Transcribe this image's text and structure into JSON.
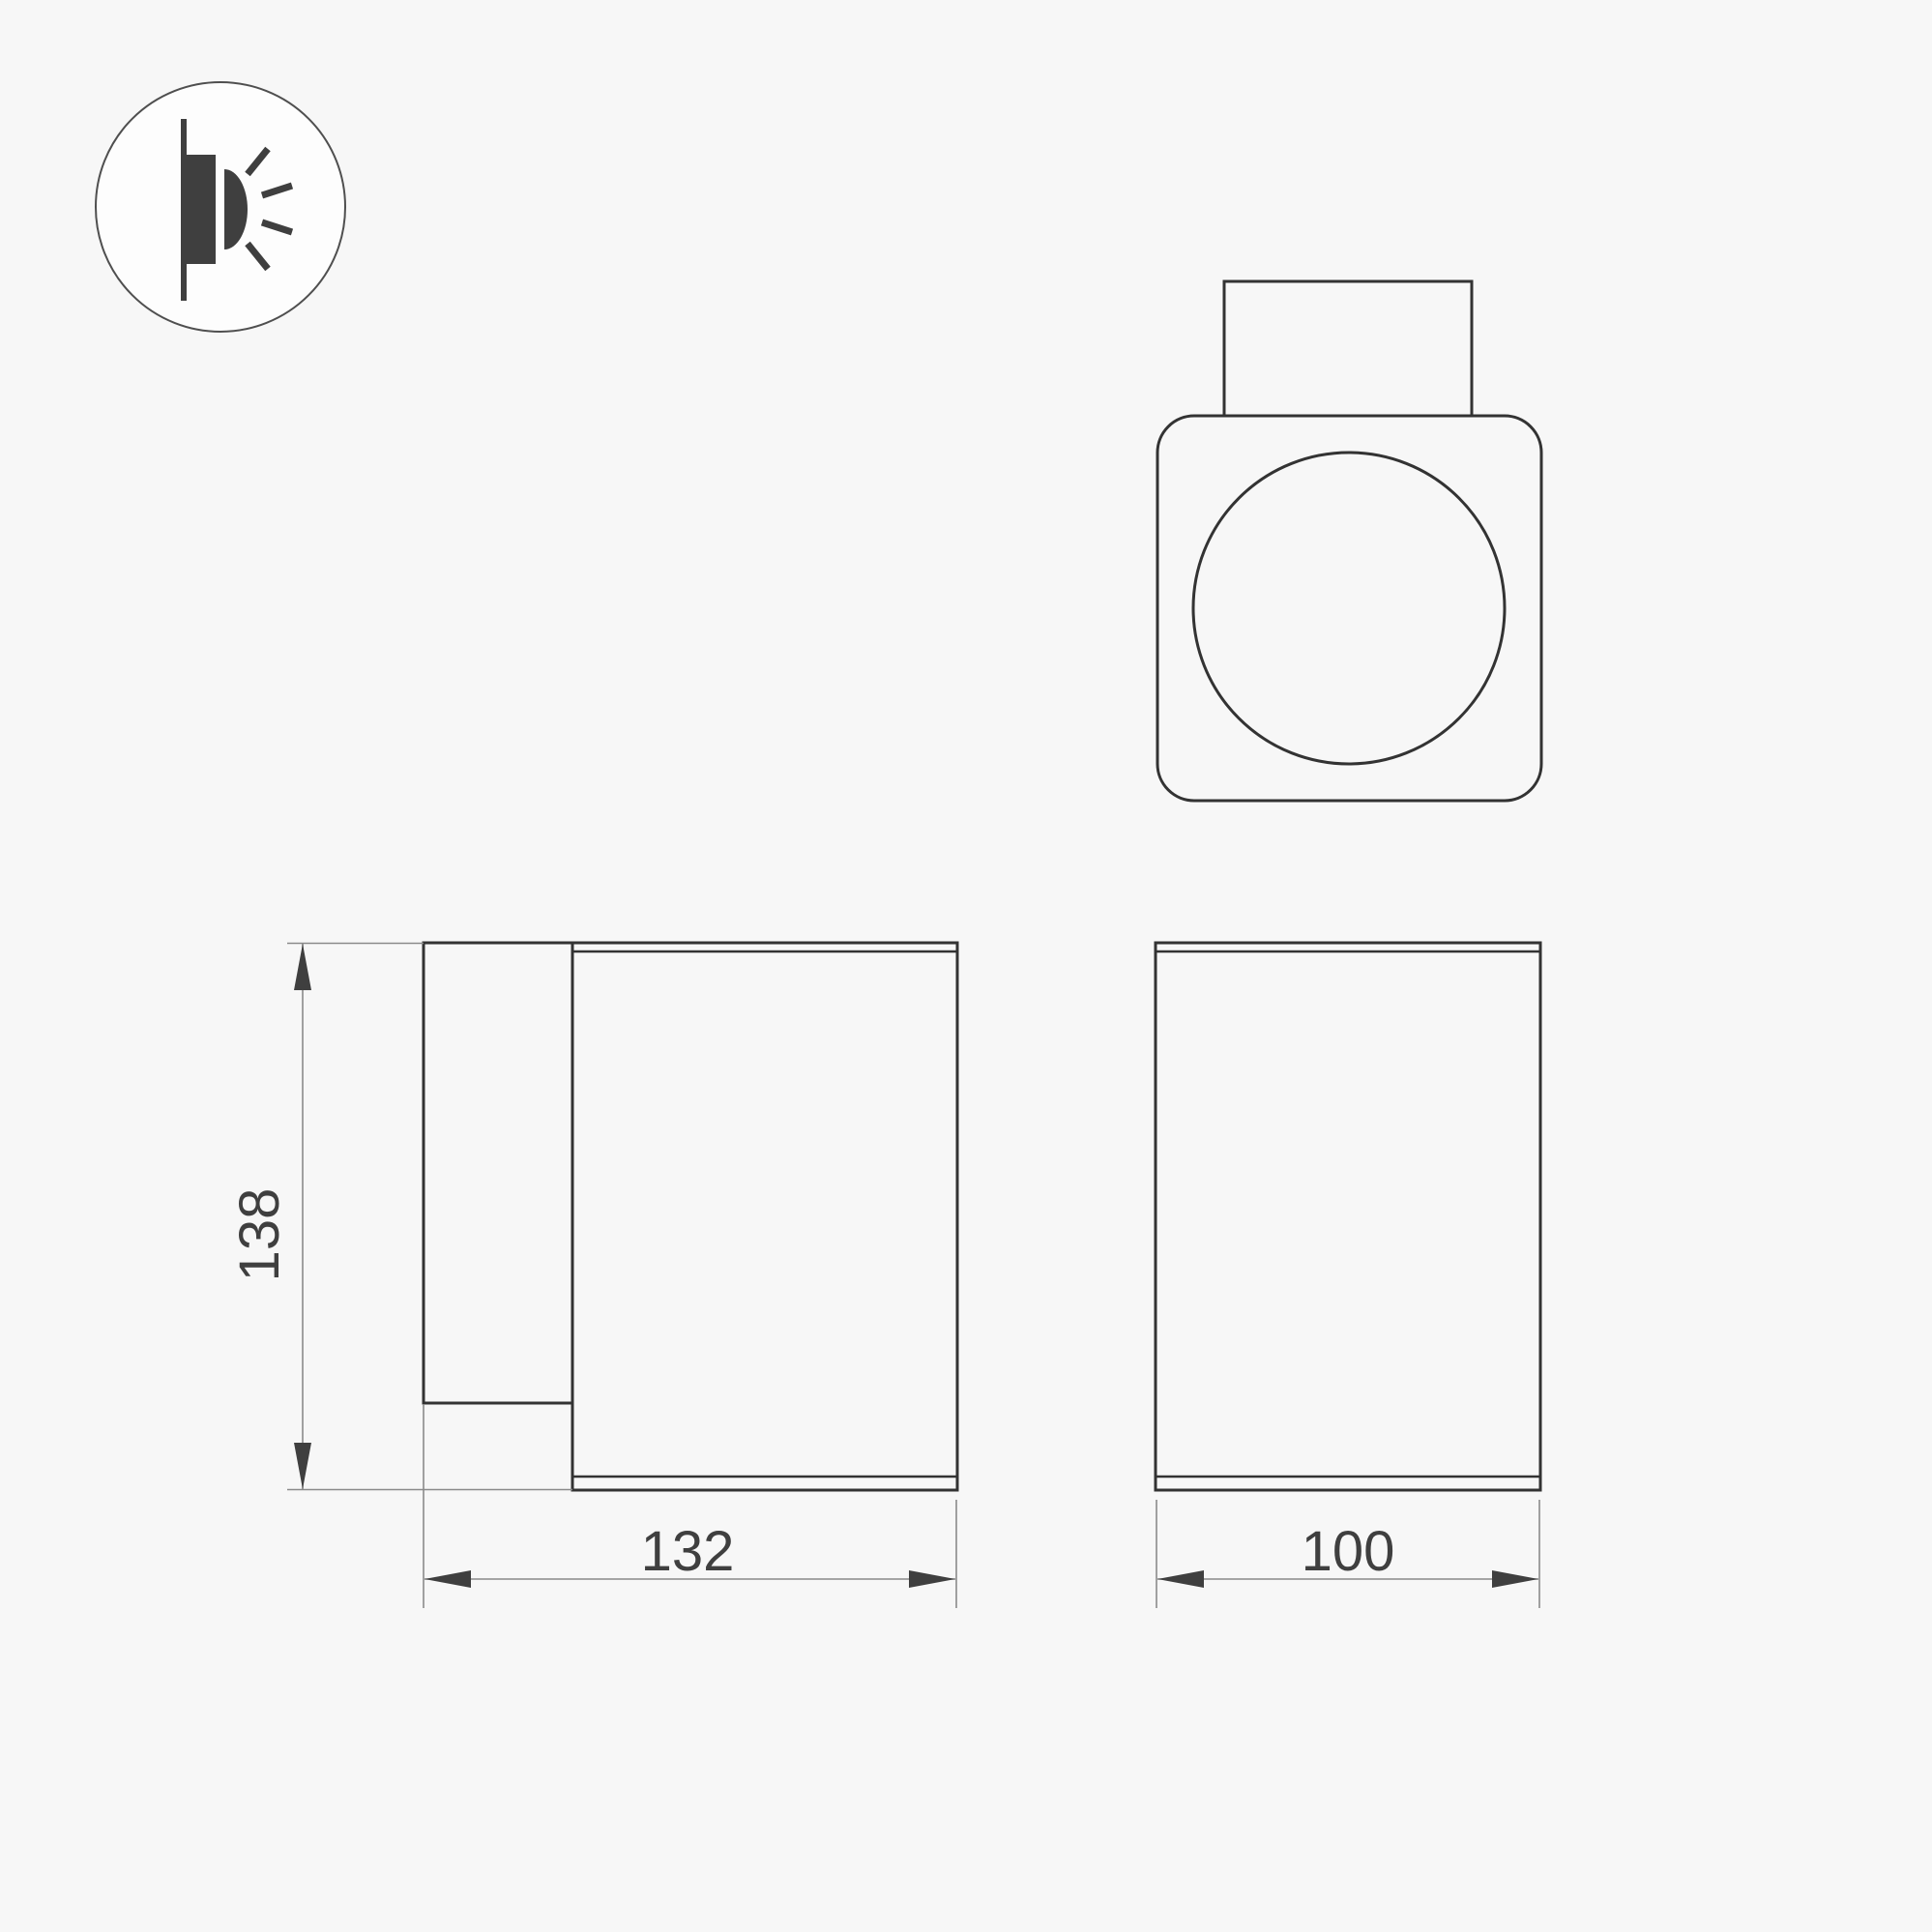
{
  "drawing": {
    "background_color": "#f7f7f7",
    "object_line_color": "#333333",
    "dimension_line_color": "#8a8a8a",
    "text_color": "#3f3f3f"
  },
  "icon": {
    "name": "wall-mounted-light-icon"
  },
  "dimensions": {
    "height": {
      "value": "138",
      "orientation": "vertical"
    },
    "depth": {
      "value": "132",
      "orientation": "horizontal"
    },
    "width": {
      "value": "100",
      "orientation": "horizontal"
    }
  }
}
